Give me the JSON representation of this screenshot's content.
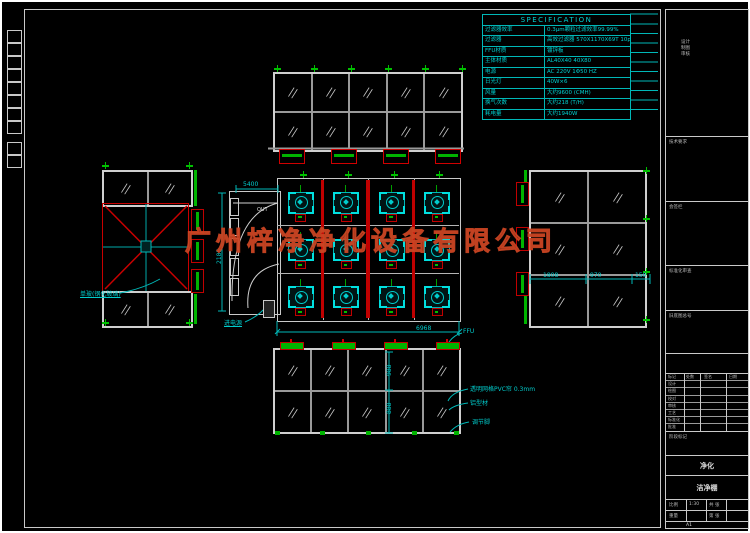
{
  "watermark": "广州梓净净化设备有限公司",
  "spec": {
    "title": "SPECIFICATION",
    "rows": [
      {
        "label": "过滤器效率",
        "value": "0.3μm颗粒过滤效率99.99%"
      },
      {
        "label": "过滤器",
        "value": "高效过滤器 570X1170X69T 10pc"
      },
      {
        "label": "FFU材质",
        "value": "镀锌板"
      },
      {
        "label": "主体材质",
        "value": "AL40X40 40X80"
      },
      {
        "label": "电源",
        "value": "AC 220V 1Φ50 HZ"
      },
      {
        "label": "日光灯",
        "value": "40W×6"
      },
      {
        "label": "风量",
        "value": "大约9600 (CMH)"
      },
      {
        "label": "换气次数",
        "value": "大约218 (T/H)"
      },
      {
        "label": "耗电量",
        "value": "大约1940W"
      }
    ]
  },
  "dims": {
    "vestibule_width": "5400",
    "plan_width": "6968",
    "plan_height": "2185",
    "right_d1": "1808",
    "right_d2": "970",
    "right_d3": "150",
    "bottom_v1": "988",
    "bottom_v2": "888"
  },
  "annotations": {
    "pvc": "透明网格PVC帘 0.3mm",
    "profile": "铝型材",
    "foot": "调节脚",
    "power": "进电源",
    "glass": "单玻(钢化玻璃)",
    "ffu": "FFU",
    "out": "OUT"
  },
  "elevations": {
    "top": {
      "cols": 5,
      "rows": 2
    },
    "bottom": {
      "cols": 5,
      "rows": 2
    },
    "right": {
      "cols": 2,
      "rows": 3
    },
    "left_top": {
      "cols": 2,
      "rows": 1
    },
    "left_bottom": {
      "cols": 2,
      "rows": 1
    }
  },
  "plan": {
    "cols": 4,
    "rows": 3,
    "ffu_count": 12
  },
  "titleblock": {
    "box1_lines": [
      "设计",
      "制图",
      "审核"
    ],
    "box2": "技术要求",
    "box3": "会签栏",
    "box4": "标准化审查",
    "box5": "旧底图总号",
    "rev_header": [
      "标记",
      "处数",
      "签名",
      "日期"
    ],
    "rev_rows": [
      "设计",
      "绘图",
      "校对",
      "审核",
      "工艺",
      "标准化",
      "批准"
    ],
    "stage": "阶段标记",
    "mark": "净化",
    "name": "洁净棚",
    "b_r1a": "比例",
    "b_r1b": "1:30",
    "b_r1c": "共 张",
    "b_r2a": "重量",
    "b_r2b": "",
    "b_r2c": "第 张",
    "sheet": "A1"
  }
}
